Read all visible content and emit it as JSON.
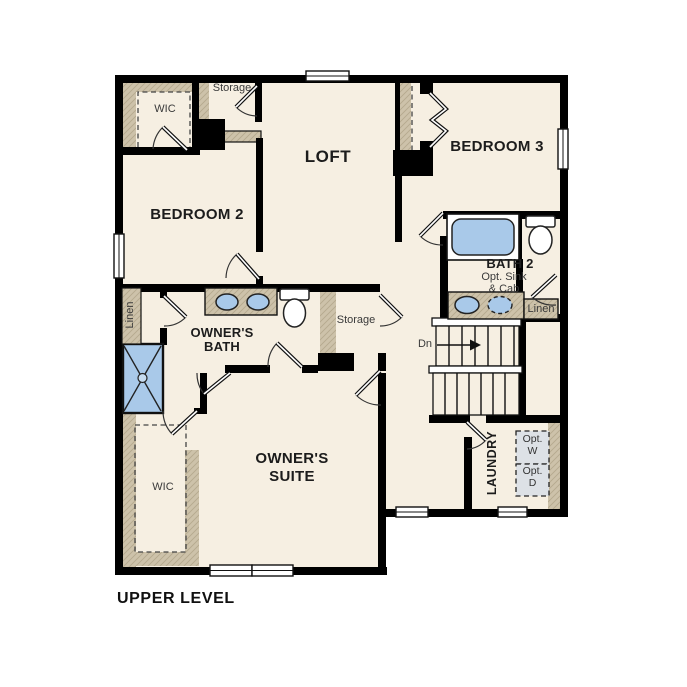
{
  "plan": {
    "title": "UPPER LEVEL",
    "rooms": {
      "loft": "LOFT",
      "bedroom2": "BEDROOM 2",
      "bedroom3": "BEDROOM 3",
      "owners_suite_line1": "OWNER'S",
      "owners_suite_line2": "SUITE",
      "owners_bath_line1": "OWNER'S",
      "owners_bath_line2": "BATH",
      "bath2": "BATH 2",
      "laundry": "LAUNDRY"
    },
    "closets": {
      "wic_top": "WIC",
      "wic_owner": "WIC",
      "storage_top": "Storage",
      "storage_hall": "Storage",
      "linen_west": "Linen",
      "linen_east": "Linen"
    },
    "annotations": {
      "bath2_opt_line1": "Opt. Sink",
      "bath2_opt_line2": "& Cab",
      "stairs_down": "Dn",
      "opt_washer_line1": "Opt.",
      "opt_washer_line2": "W",
      "opt_dryer_line1": "Opt.",
      "opt_dryer_line2": "D"
    },
    "colors": {
      "floor": "#f6efe2",
      "wall": "#000000",
      "wood_wall": "#cdc2aa",
      "fixture_blue": "#a9c9e9",
      "optional_appliance_fill": "#dde1e6"
    }
  }
}
